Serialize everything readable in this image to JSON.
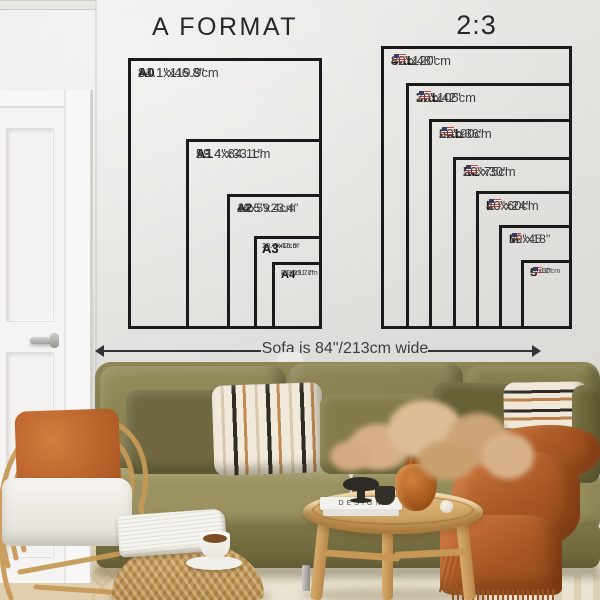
{
  "charts": {
    "a_format": {
      "title": "A FORMAT",
      "items": [
        {
          "name": "A0",
          "inches": "31.1\"x46.8\"",
          "cm": "84.1x119.9cm"
        },
        {
          "name": "A1",
          "inches": "23.4\"x33.1\"",
          "cm": "59.4x84.1cm"
        },
        {
          "name": "A2",
          "inches": "16.5\"x23.4\"",
          "cm": "42x59.4cm"
        },
        {
          "name": "A3",
          "inches": "11.7\"x16.5\"",
          "cm": "29.7x42cm"
        },
        {
          "name": "A4",
          "inches": "8.3\"x11.7\"",
          "cm": "21x29.7cm"
        }
      ]
    },
    "ratio": {
      "title": "2:3",
      "flag_icon": "us-flag-icon",
      "items": [
        {
          "name": "4XL",
          "inches": "32\"x48\"",
          "cm": "80x120cm"
        },
        {
          "name": "3XL",
          "inches": "28\"x42\"",
          "cm": "70x105cm"
        },
        {
          "name": "2XL",
          "inches": "24\"x36\"",
          "cm": "60x90cm"
        },
        {
          "name": "XL",
          "inches": "20\"x30\"",
          "cm": "50x75cm"
        },
        {
          "name": "L",
          "inches": "16\"x24\"",
          "cm": "40x60cm"
        },
        {
          "name": "M",
          "inches": "12\"x18\"",
          "cm": "30x45"
        },
        {
          "name": "S",
          "inches": "8\"x12\"",
          "cm": "20x30cm"
        }
      ]
    }
  },
  "annotation": {
    "sofa_width": "Sofa is 84\"/213cm wide"
  },
  "decor": {
    "book_spine": "DESIGN"
  },
  "colors": {
    "wall": "#e2e0dc",
    "chart_line": "#1a1a1a",
    "sofa_olive": "#877f4e",
    "accent_rust": "#bc6a31",
    "wood": "#cfa566"
  }
}
